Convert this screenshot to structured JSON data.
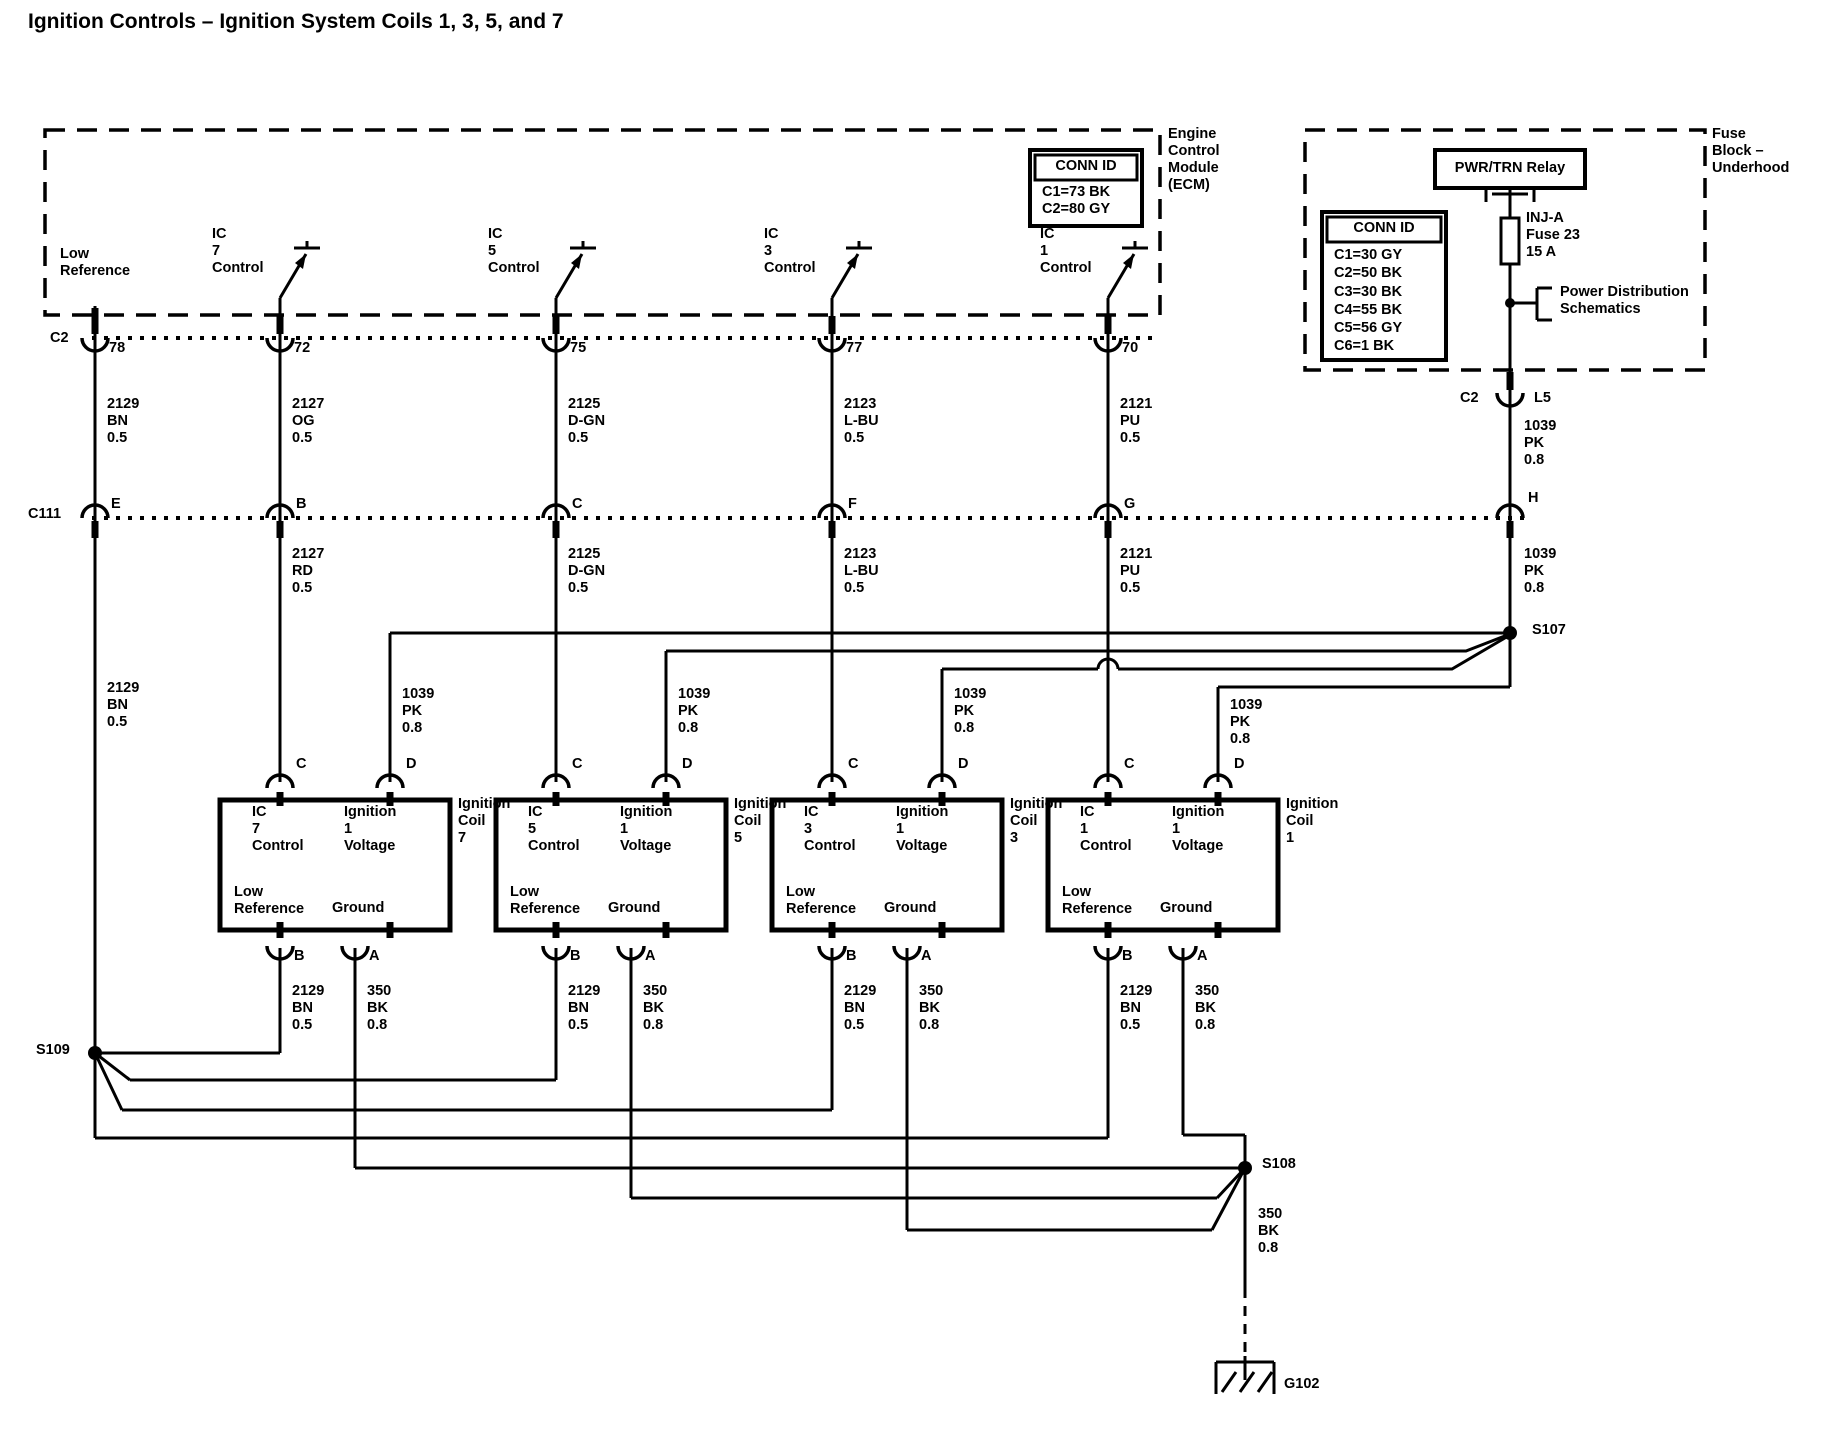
{
  "title": "Ignition Controls – Ignition System Coils 1, 3, 5, and 7",
  "ecm": {
    "label": "Engine\nControl\nModule\n(ECM)",
    "low_reference": "Low\nReference",
    "switches": [
      "IC\n7\nControl",
      "IC\n5\nControl",
      "IC\n3\nControl",
      "IC\n1\nControl"
    ],
    "conn_id": {
      "header": "CONN ID",
      "rows": "C1=73 BK\nC2=80 GY"
    }
  },
  "fuse_block": {
    "label": "Fuse\nBlock –\nUnderhood",
    "relay": "PWR/TRN Relay",
    "conn_id": {
      "header": "CONN ID",
      "rows": "C1=30 GY\nC2=50 BK\nC3=30 BK\nC4=55 BK\nC5=56 GY\nC6=1 BK"
    },
    "fuse": "INJ-A\nFuse 23\n15 A",
    "power_dist": "Power Distribution\nSchematics",
    "c2": "C2",
    "pin_l5": "L5"
  },
  "rows": {
    "c2_label": "C2",
    "c2_pins": [
      "78",
      "72",
      "75",
      "77",
      "70"
    ],
    "c111_label": "C111",
    "c111_pins": [
      "E",
      "B",
      "C",
      "F",
      "G",
      "H"
    ]
  },
  "wires": {
    "row1": [
      "2129\nBN\n0.5",
      "2127\nOG\n0.5",
      "2125\nD-GN\n0.5",
      "2123\nL-BU\n0.5",
      "2121\nPU\n0.5"
    ],
    "row2": [
      "2129\nBN\n0.5",
      "2127\nRD\n0.5",
      "2125\nD-GN\n0.5",
      "2123\nL-BU\n0.5",
      "2121\nPU\n0.5"
    ],
    "pk_upper": "1039\nPK\n0.8",
    "pk_lower": "1039\nPK\n0.8",
    "coil_feed": [
      "1039\nPK\n0.8",
      "1039\nPK\n0.8",
      "1039\nPK\n0.8",
      "1039\nPK\n0.8"
    ],
    "b_labels": [
      "2129\nBN\n0.5",
      "2129\nBN\n0.5",
      "2129\nBN\n0.5",
      "2129\nBN\n0.5"
    ],
    "a_labels": [
      "350\nBK\n0.8",
      "350\nBK\n0.8",
      "350\nBK\n0.8",
      "350\nBK\n0.8"
    ],
    "s108_down": "350\nBK\n0.8"
  },
  "coils": [
    {
      "name": "Ignition\nCoil\n7",
      "tl": "IC\n7\nControl",
      "tr": "Ignition\n1\nVoltage",
      "bl": "Low\nReference",
      "br": "Ground",
      "pc": "C",
      "pd": "D",
      "pb": "B",
      "pa": "A"
    },
    {
      "name": "Ignition\nCoil\n5",
      "tl": "IC\n5\nControl",
      "tr": "Ignition\n1\nVoltage",
      "bl": "Low\nReference",
      "br": "Ground",
      "pc": "C",
      "pd": "D",
      "pb": "B",
      "pa": "A"
    },
    {
      "name": "Ignition\nCoil\n3",
      "tl": "IC\n3\nControl",
      "tr": "Ignition\n1\nVoltage",
      "bl": "Low\nReference",
      "br": "Ground",
      "pc": "C",
      "pd": "D",
      "pb": "B",
      "pa": "A"
    },
    {
      "name": "Ignition\nCoil\n1",
      "tl": "IC\n1\nControl",
      "tr": "Ignition\n1\nVoltage",
      "bl": "Low\nReference",
      "br": "Ground",
      "pc": "C",
      "pd": "D",
      "pb": "B",
      "pa": "A"
    }
  ],
  "splices": {
    "s107": "S107",
    "s108": "S108",
    "s109": "S109"
  },
  "ground": "G102"
}
